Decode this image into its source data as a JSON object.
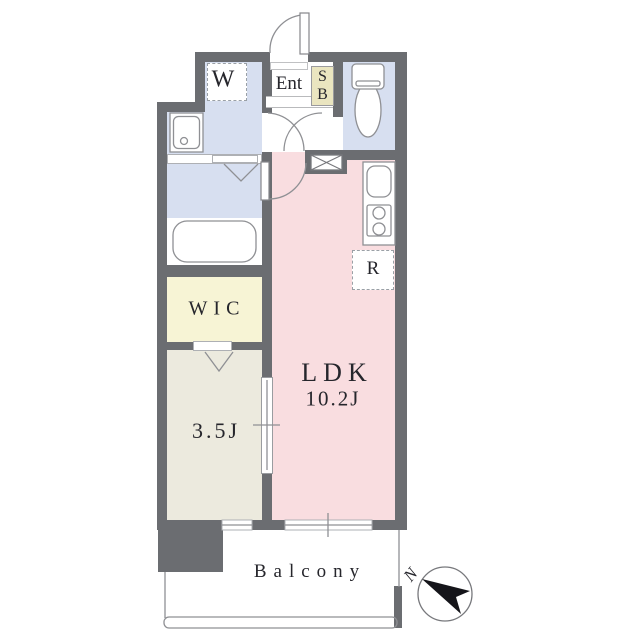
{
  "floorplan": {
    "labels": {
      "washer": "W",
      "entrance": "Ent",
      "shoebox_s": "S",
      "shoebox_b": "B",
      "wic": "WIC",
      "bedroom": "3.5J",
      "ldk": "LDK",
      "ldk_size": "10.2J",
      "refrigerator": "R",
      "balcony": "Balcony",
      "north": "N"
    },
    "colors": {
      "wall": "#6b6d71",
      "ldk_floor": "#f9dde0",
      "wet_area_floor": "#d7dff0",
      "wic_floor": "#f7f4d5",
      "shoebox_fill": "#eae5c0",
      "bedroom_floor": "#eceade",
      "outline": "#8f9094",
      "north_arrow": "#15151a"
    }
  }
}
